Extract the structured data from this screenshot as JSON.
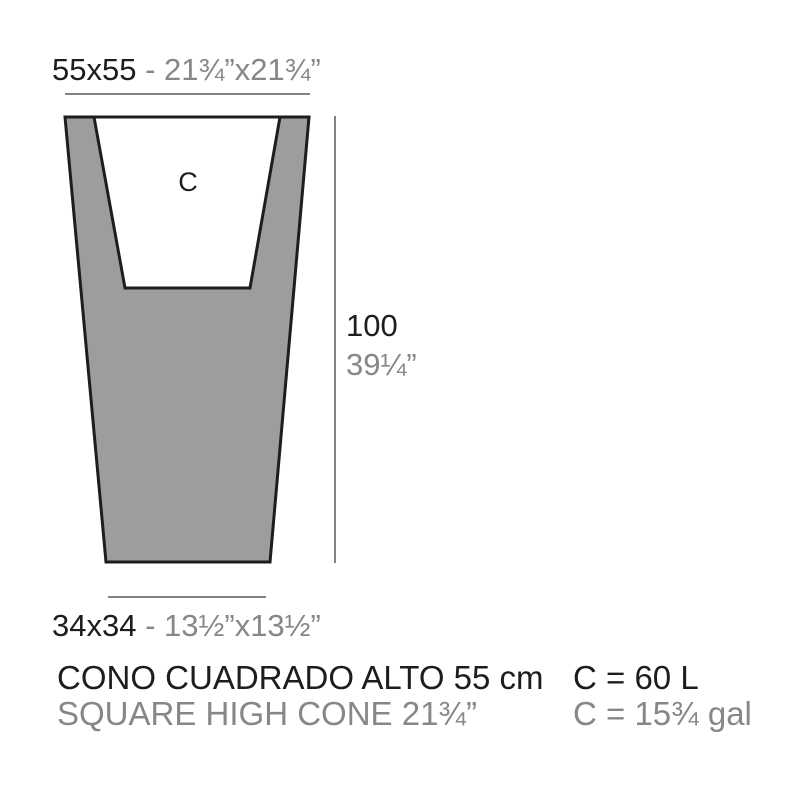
{
  "colors": {
    "ink_dark": "#1d1d1b",
    "ink_gray": "#878787",
    "planter_fill": "#9d9d9d",
    "outline": "#1d1d1b",
    "dimension_line": "#828282"
  },
  "diagram": {
    "top_dimension": {
      "metric": "55x55",
      "separator": " - ",
      "imperial": "21¾”x21¾”"
    },
    "height_dimension": {
      "metric": "100",
      "imperial": "39¼”"
    },
    "base_dimension": {
      "metric": "34x34",
      "separator": " - ",
      "imperial": "13½”x13½”"
    },
    "cavity_label": "C"
  },
  "caption": {
    "product_name_es": "CONO CUADRADO ALTO 55 cm",
    "product_name_en": "SQUARE HIGH CONE 21¾”",
    "capacity_metric": "C = 60 L",
    "capacity_imperial": "C = 15¾ gal"
  }
}
